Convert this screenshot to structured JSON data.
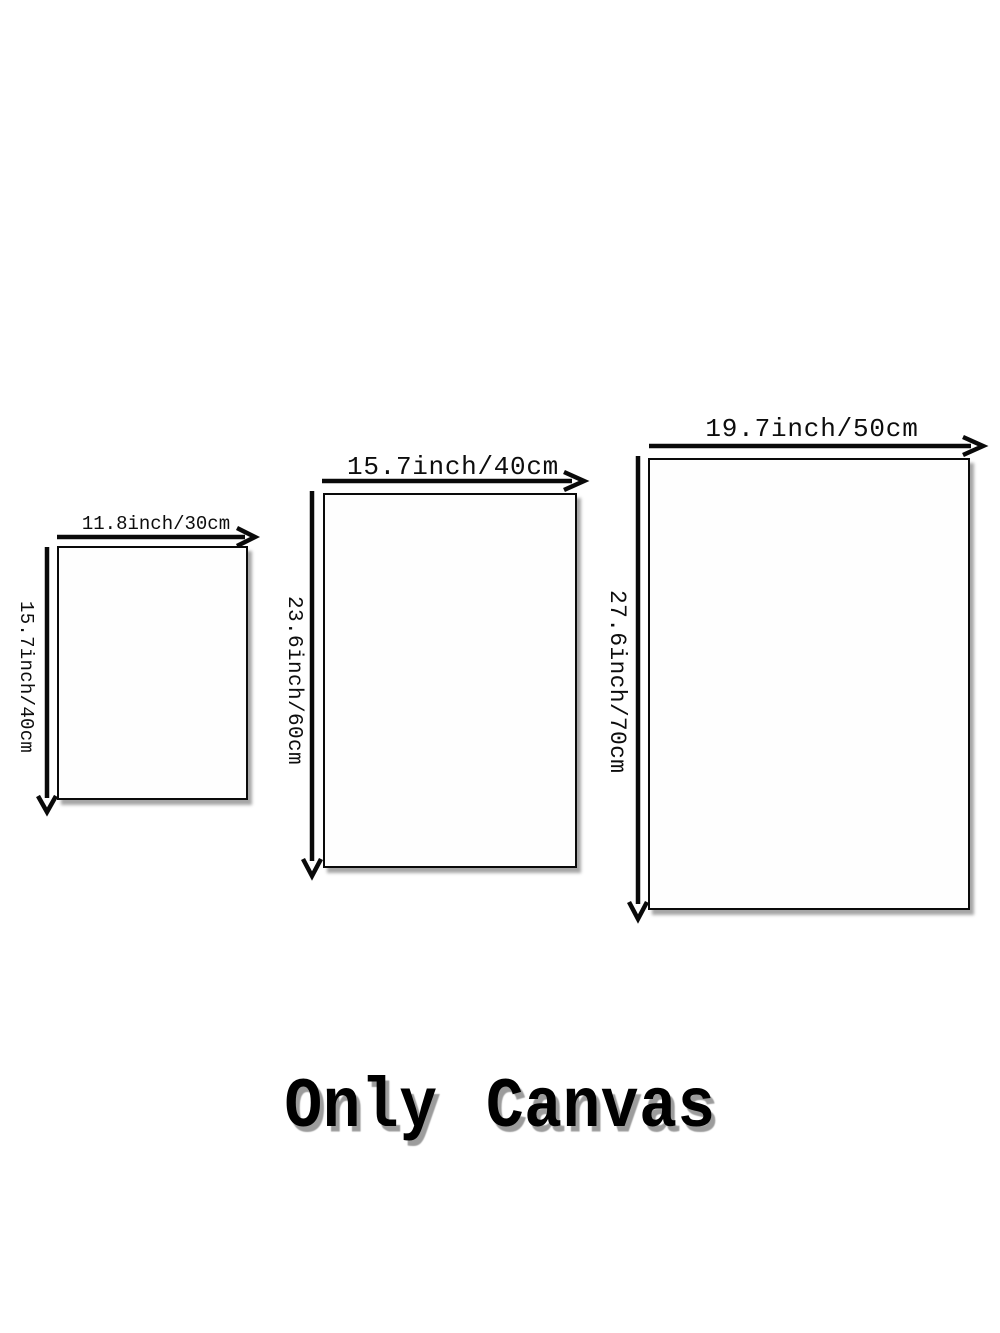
{
  "page": {
    "background_color": "#ffffff",
    "line_color": "#0a0a0a",
    "shadow_color": "#9c9c9c"
  },
  "title": {
    "label": "Only Canvas"
  },
  "sizes": [
    {
      "width_label": "11.8inch/30cm",
      "height_label": "15.7inch/40cm"
    },
    {
      "width_label": "15.7inch/40cm",
      "height_label": "23.6inch/60cm"
    },
    {
      "width_label": "19.7inch/50cm",
      "height_label": "27.6inch/70cm"
    }
  ]
}
